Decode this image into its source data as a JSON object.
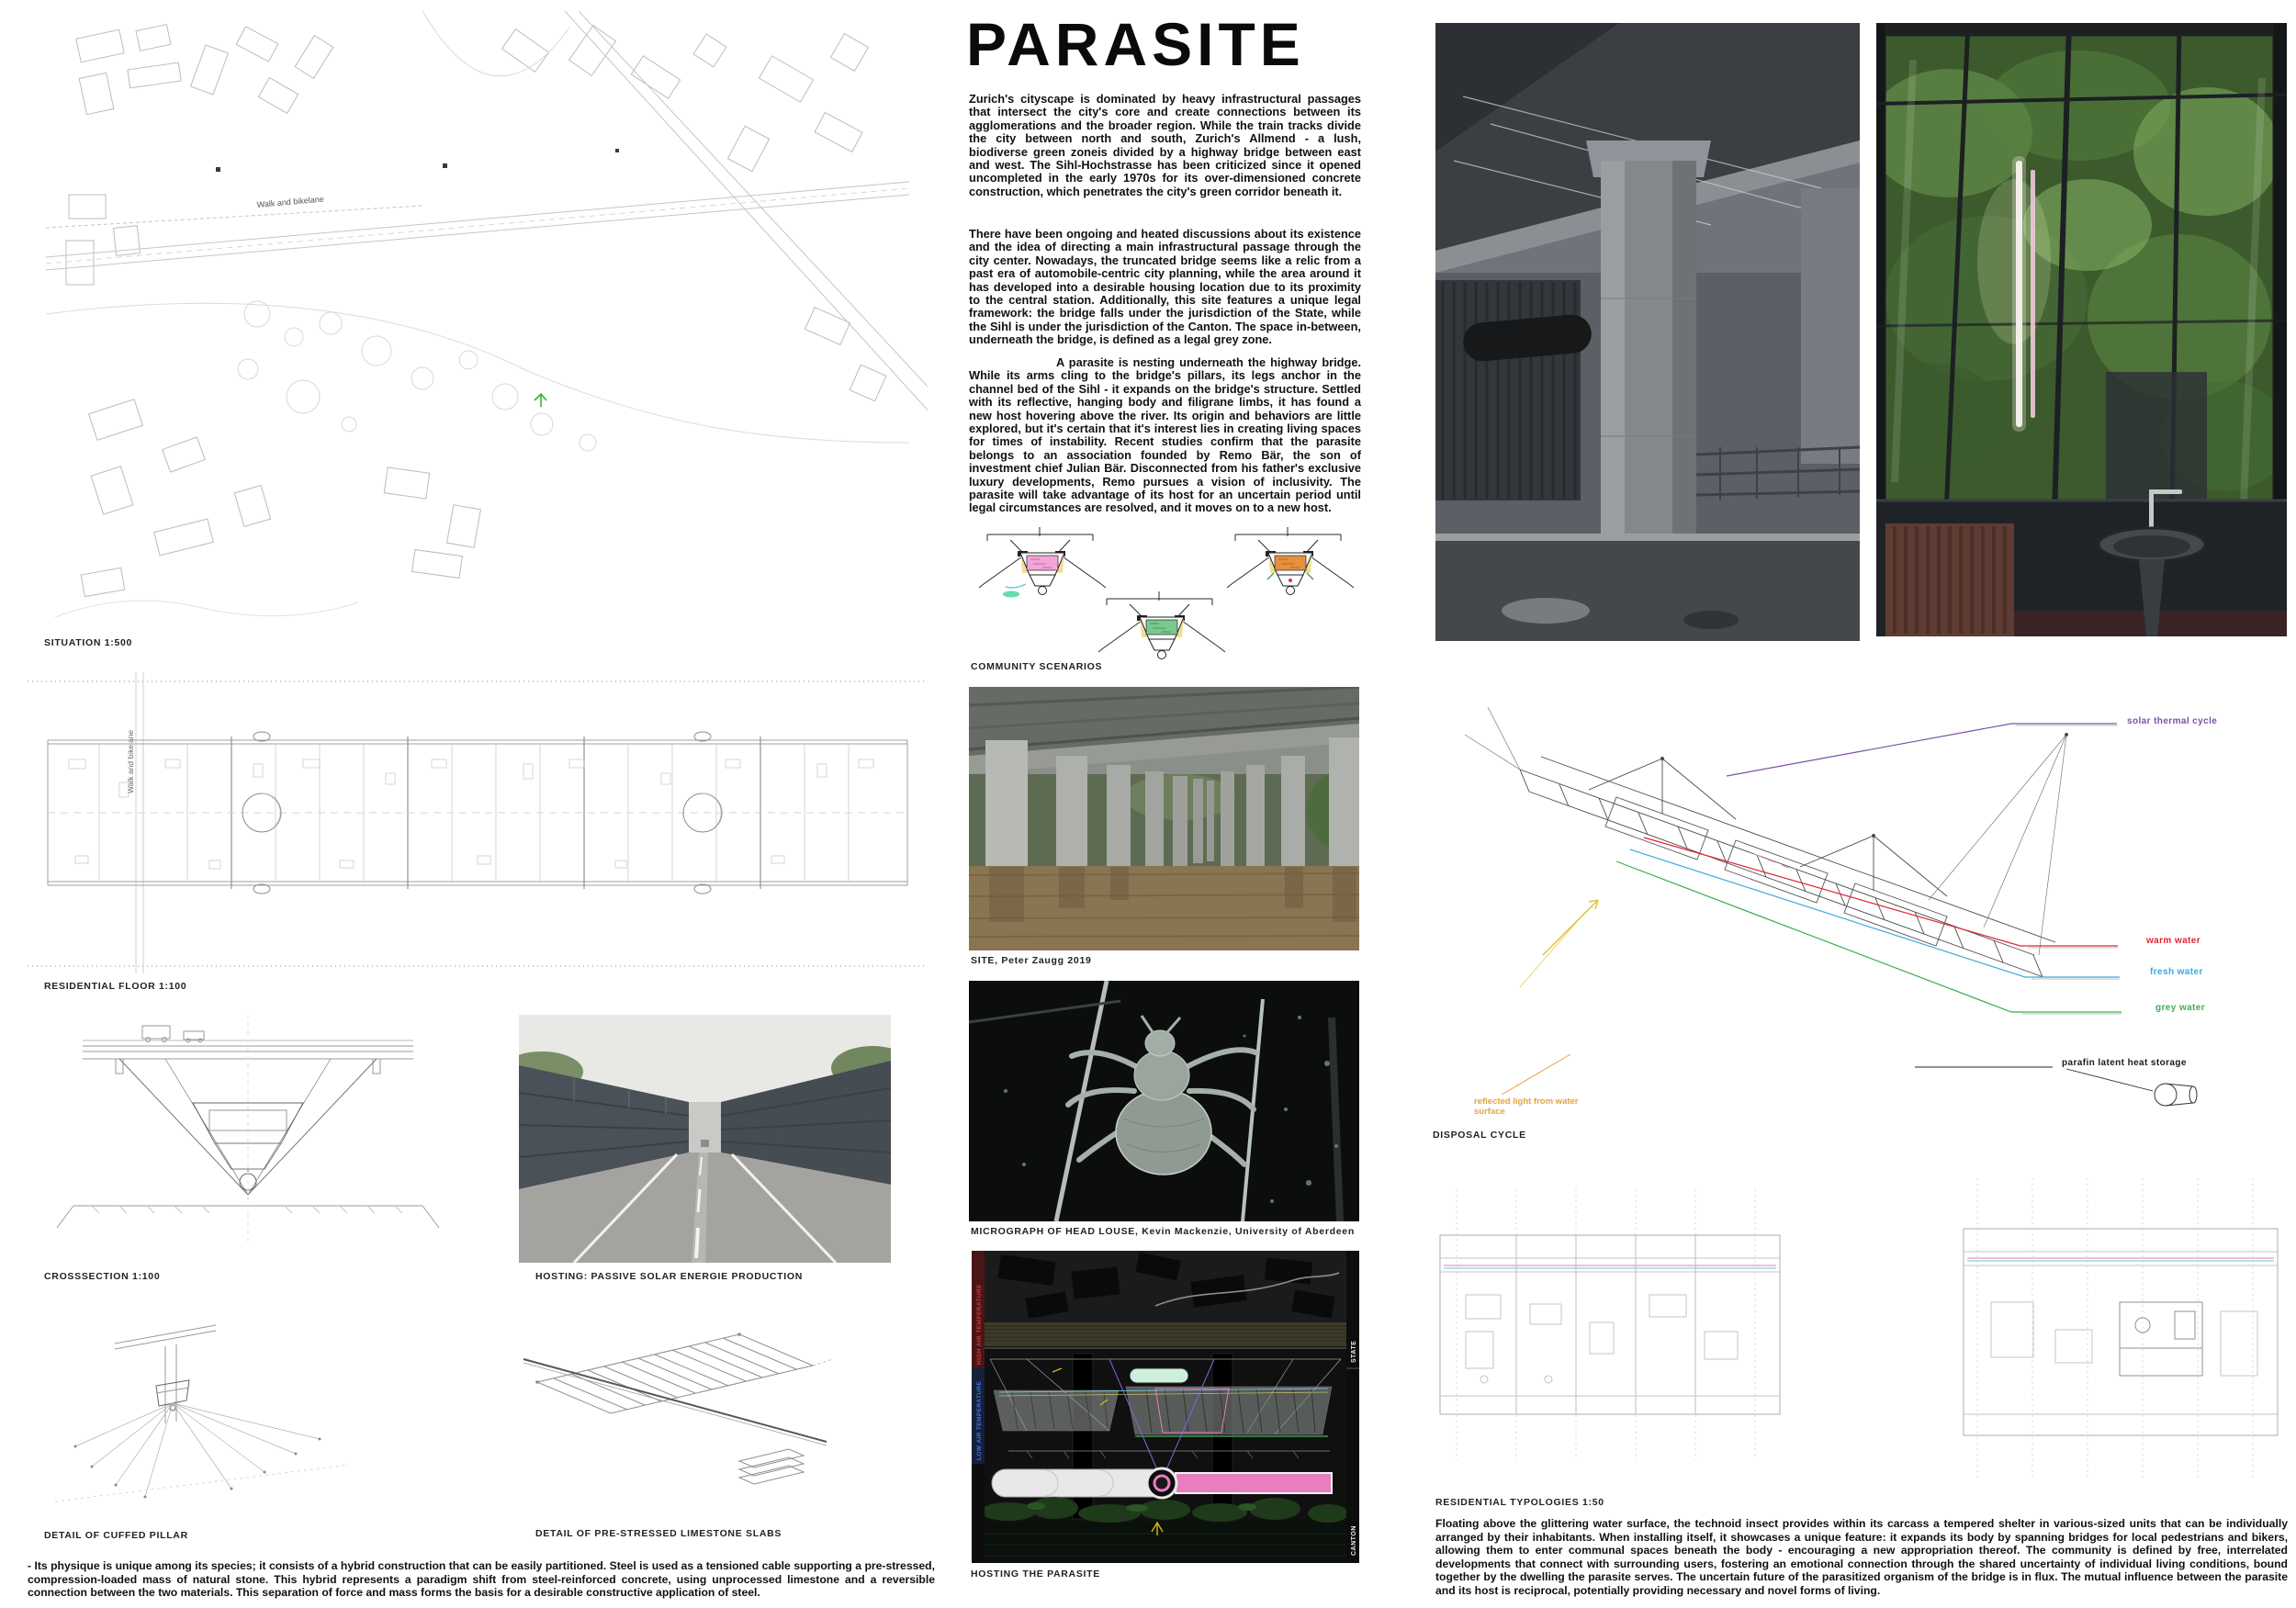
{
  "poster": {
    "title": "PARASITE"
  },
  "left": {
    "situation_caption": "SITUATION 1:500",
    "walk_label": "Walk and bikelane",
    "residential_caption": "RESIDENTIAL FLOOR 1:100",
    "crosssection_caption": "CROSSSECTION 1:100",
    "hosting_photo_caption": "HOSTING: PASSIVE SOLAR ENERGIE PRODUCTION",
    "detail_pillar_caption": "DETAIL OF CUFFED PILLAR",
    "detail_slabs_caption": "DETAIL OF PRE-STRESSED LIMESTONE SLABS",
    "bottom_text": "- Its physique is unique among its species; it consists of a hybrid construction that can be easily partitioned. Steel is used as a tensioned cable supporting a pre-stressed, compression-loaded mass of natural stone. This hybrid represents a paradigm shift from steel-reinforced concrete, using unprocessed limestone and a reversible connection between the two materials. This separation of force and mass forms the basis for a desirable constructive application of steel."
  },
  "middle": {
    "paragraph_1": "Zurich's cityscape is dominated by heavy infrastructural passages that intersect the city's core and create connections between its agglomerations and the broader region. While the train tracks divide the city between north and south, Zurich's Allmend - a lush, biodiverse green zoneis divided by a highway bridge between east and west. The Sihl-Hochstrasse has been criticized since it opened uncompleted in the early 1970s for its over-dimensioned concrete construction, which penetrates the city's green corridor beneath it.",
    "paragraph_2": "There have been ongoing and heated discussions about its existence and the idea of directing a main infrastructural passage through the city center. Nowadays, the truncated bridge seems like a relic from a past era of automobile-centric city planning, while the area around it has developed into a desirable housing location due to its proximity to the central station. Additionally, this site features a unique legal framework: the bridge falls under the jurisdiction of the State, while the Sihl is under the jurisdiction of the Canton. The space in-between, underneath the bridge, is defined as a legal grey zone.",
    "paragraph_3": "A parasite is nesting underneath the highway bridge. While its arms cling to the bridge's pillars, its legs anchor in the channel bed of the Sihl - it expands on the bridge's structure. Settled with its reflective, hanging body and filigrane limbs, it has found a new host hovering above the river. Its origin and behaviors are little explored, but it's certain that it's interest lies in creating living spaces for times of instability. Recent studies confirm that the parasite belongs to an association founded by Remo Bär, the son of investment chief Julian Bär. Disconnected from his father's exclusive luxury developments, Remo pursues a vision of inclusivity. The parasite will take advantage of its host for an uncertain period until legal circumstances are resolved, and it moves on to a new host.",
    "community_caption": "COMMUNITY SCENARIOS",
    "site_caption": "SITE, Peter Zaugg 2019",
    "micrograph_caption": "MICROGRAPH OF HEAD LOUSE, Kevin Mackenzie, University of Aberdeen",
    "hosting_caption": "HOSTING THE PARASITE"
  },
  "right": {
    "disposal_caption": "DISPOSAL CYCLE",
    "typologies_caption": "RESIDENTIAL TYPOLOGIES 1:50",
    "bottom_text": "Floating above the glittering water surface, the technoid insect provides within its carcass a tempered shelter in various-sized units that can be individually arranged by their inhabitants.  When installing itself, it showcases a unique feature: it expands its body by spanning bridges for local pedestrians and bikers, allowing them to enter communal spaces beneath the body - encouraging a new appropriation thereof. The community is defined by free, interrelated developments that connect with surrounding users, fostering an emotional connection through the shared uncertainty of individual living conditions, bound together by the dwelling the parasite serves. The uncertain future of the parasitized organism of the bridge is in flux. The mutual influence between the parasite and its host is reciprocal, potentially providing necessary and novel forms of living.",
    "labels": {
      "solar": {
        "text": "solar thermal cycle",
        "color": "#7b4fae"
      },
      "warm": {
        "text": "warm water",
        "color": "#e02434"
      },
      "fresh": {
        "text": "fresh water",
        "color": "#3fa9dc"
      },
      "grey": {
        "text": "grey water",
        "color": "#3fae4c"
      },
      "parafin": {
        "text": "parafin latent heat storage",
        "color": "#1a1a1a"
      },
      "reflected": {
        "text": "reflected light from water surface",
        "color": "#e5a43c"
      }
    }
  },
  "hosting_diagram": {
    "high_temp": "HIGH AIR TEMPERATURE",
    "low_temp": "LOW AIR TEMPERATURE",
    "state": "STATE",
    "canton": "CANTON"
  }
}
